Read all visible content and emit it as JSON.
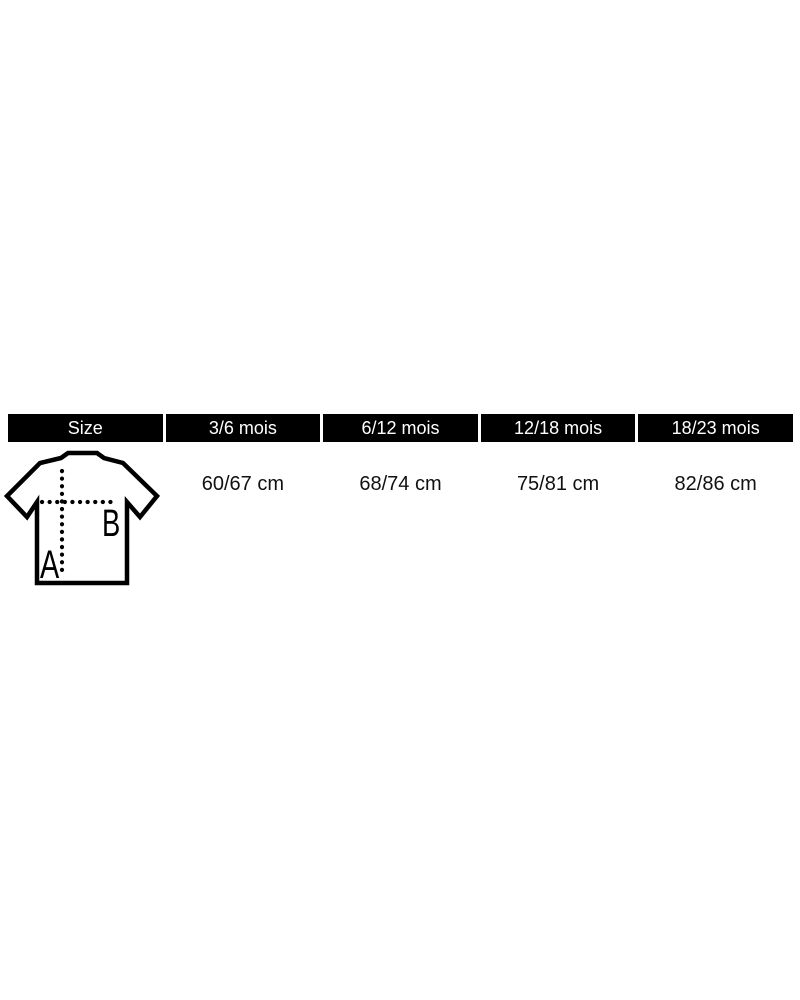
{
  "size_chart": {
    "header": {
      "size_label": "Size",
      "age_columns": [
        "3/6 mois",
        "6/12 mois",
        "12/18 mois",
        "18/23 mois"
      ]
    },
    "measurements": [
      "60/67 cm",
      "68/74 cm",
      "75/81 cm",
      "82/86 cm"
    ],
    "diagram": {
      "height_label": "A",
      "width_label": "B"
    },
    "colors": {
      "header_bg": "#000000",
      "header_text": "#ffffff",
      "body_text": "#111111",
      "line": "#000000",
      "page_bg": "#ffffff"
    }
  },
  "chart_data": {
    "type": "table",
    "columns": [
      "Size",
      "3/6 mois",
      "6/12 mois",
      "12/18 mois",
      "18/23 mois"
    ],
    "rows": [
      [
        "t-shirt diagram A/B",
        "60/67 cm",
        "68/74 cm",
        "75/81 cm",
        "82/86 cm"
      ]
    ],
    "diagram_labels": [
      "A",
      "B"
    ]
  }
}
